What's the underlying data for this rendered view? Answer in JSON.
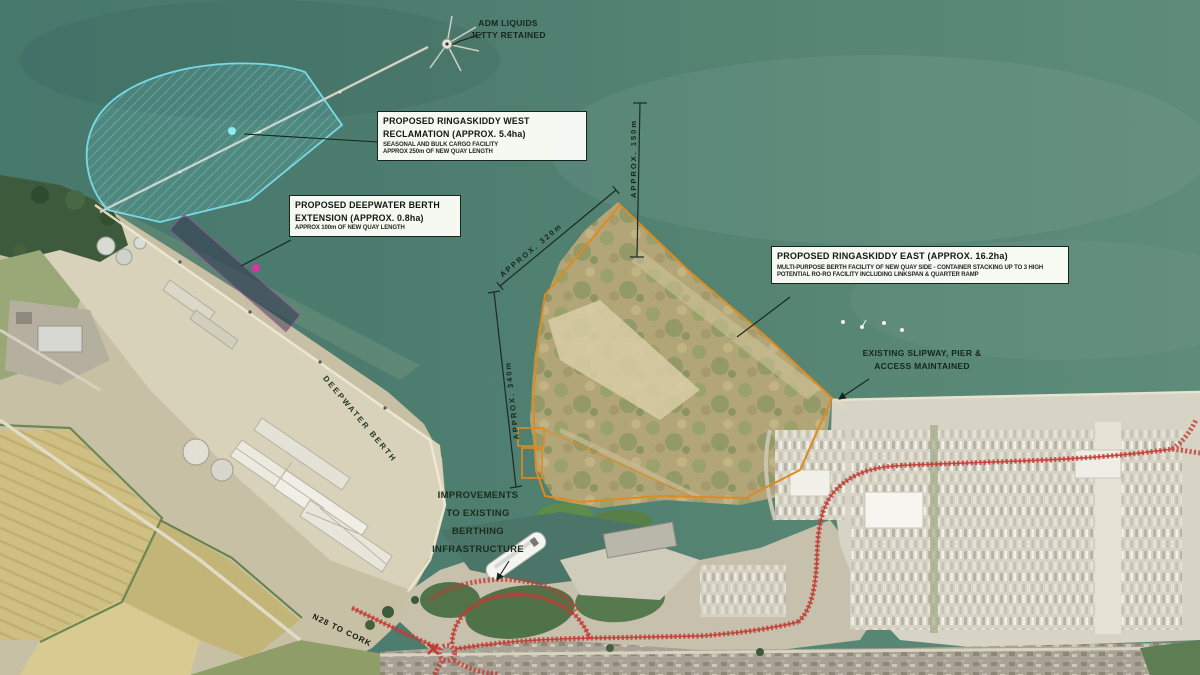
{
  "labels": {
    "adm": {
      "line1": "ADM LIQUIDS",
      "line2": "JETTY RETAINED"
    },
    "west": {
      "line1": "PROPOSED RINGASKIDDY WEST",
      "line2": "RECLAMATION (APPROX. 5.4ha)",
      "sub1": "SEASONAL AND BULK CARGO FACILITY",
      "sub2": "APPROX 250m OF NEW QUAY LENGTH"
    },
    "deep": {
      "line1": "PROPOSED DEEPWATER BERTH",
      "line2": "EXTENSION (APPROX. 0.8ha)",
      "sub1": "APPROX 100m OF NEW QUAY LENGTH"
    },
    "east": {
      "line1": "PROPOSED RINGASKIDDY EAST (APPROX. 16.2ha)",
      "sub1": "MULTI-PURPOSE BERTH FACILITY OF NEW QUAY SIDE - CONTAINER STACKING UP TO 3 HIGH",
      "sub2": "POTENTIAL RO-RO FACILITY INCLUDING LINKSPAN & QUARTER RAMP"
    },
    "slipway": {
      "line1": "EXISTING SLIPWAY, PIER &",
      "line2": "ACCESS MAINTAINED"
    },
    "improvements": {
      "line1": "IMPROVEMENTS",
      "line2": "TO EXISTING",
      "line3": "BERTHING",
      "line4": "INFRASTRUCTURE"
    },
    "deepwater_berth": "DEEPWATER BERTH",
    "n28": "N28 TO CORK"
  },
  "dimensions": {
    "d1": "APPROX. 320m",
    "d2": "APPROX. 150m",
    "d3": "APPROX. 340m"
  },
  "colors": {
    "water": "#4f7e6f",
    "reclamation_cyan": "#7be0ee",
    "berth_magenta": "#d8359f",
    "east_orange": "#e08a20",
    "road_red": "#c23b33"
  }
}
